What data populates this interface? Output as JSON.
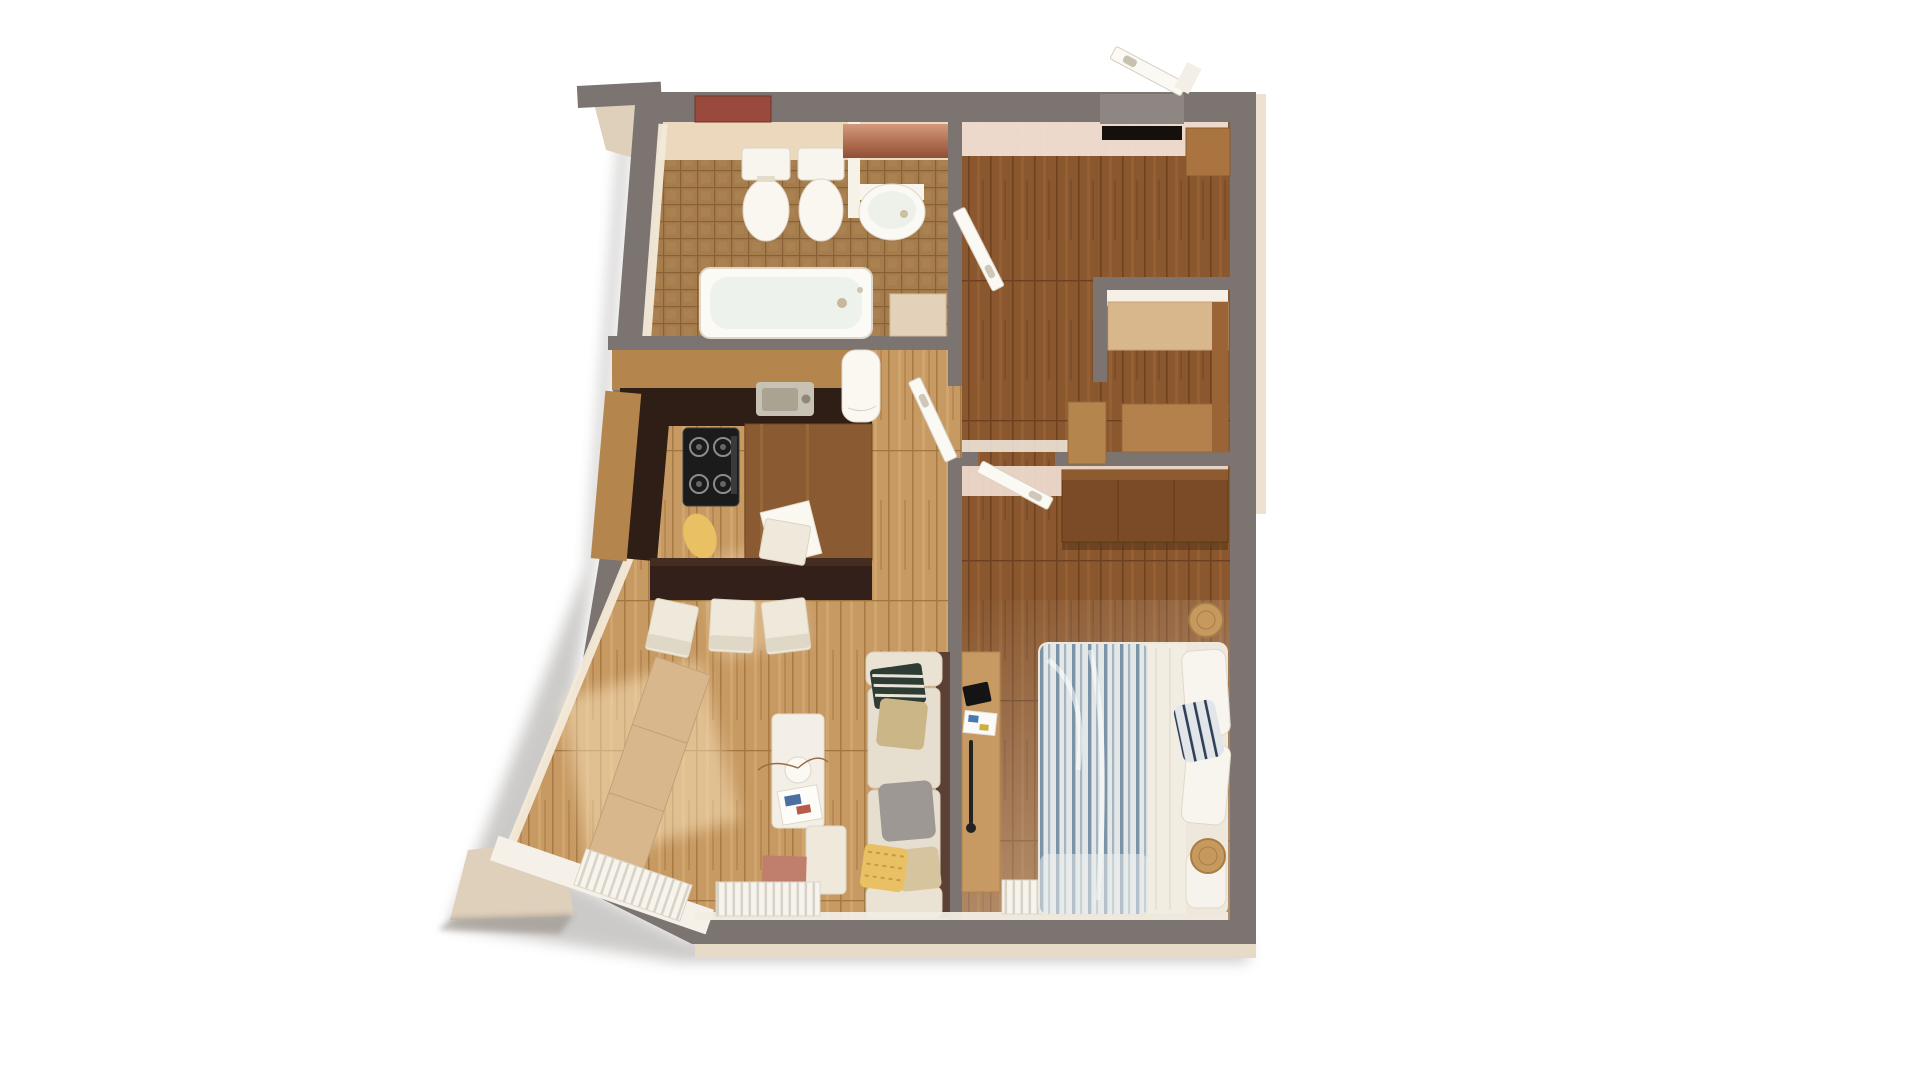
{
  "scene": {
    "type": "3d-floor-plan-render",
    "view": "top-down-axonometric",
    "canvas": {
      "width": 1920,
      "height": 1080
    },
    "background": "#ffffff",
    "visible_text": []
  },
  "palette": {
    "background": "#ffffff",
    "wall": "#7b7471",
    "wallEdge": "#8d8682",
    "plasterPink": "#f2e0d4",
    "tileFloor": "#a57c4c",
    "tileWall": "#ecd9bd",
    "woodFloorLight": "#c79a63",
    "woodFloorDark": "#8a572e",
    "woodLight": "#d9b78c",
    "woodMid": "#b5854e",
    "woodDark": "#7b4a26",
    "espresso": "#33201a",
    "counterDark": "#2e1e16",
    "white": "#f6f1e8",
    "cream": "#efe9dc",
    "copper": "#bf8066",
    "ventRed": "#9a4a3c",
    "terracotta": "#c07f6d",
    "yellow": "#e9c063",
    "khaki": "#cbb687",
    "olive": "#4a5a4a",
    "grayPillow": "#9e9894",
    "steel": "#c8c2b4",
    "black": "#1b1b1b",
    "balcony": "#ded0bb",
    "sofa": "#e6dfd0",
    "sofaBack": "#5d4034"
  },
  "rooms": {
    "bathroom": {
      "label": "bathroom",
      "floor": "brown mosaic tile",
      "fixtures": [
        "bathtub",
        "toilet",
        "bidet-toilet",
        "partition",
        "wall-hung-sink",
        "storage-cabinet",
        "copper-cabinet-row"
      ]
    },
    "hallway": {
      "label": "entrance hallway",
      "floor": "dark walnut planks",
      "fixtures": [
        "entrance-door-open-outward",
        "black-doormat",
        "shoe-cabinet",
        "bathroom-door-open",
        "living-room-door-open",
        "corridor-cabinet"
      ]
    },
    "closet": {
      "label": "walk-in closet",
      "floor": "dark walnut planks",
      "fixtures": [
        "upper-wood-counter",
        "lower-wood-counter",
        "side-wood-panel"
      ]
    },
    "kitchen_living": {
      "label": "kitchen and living room",
      "floor": "light oak planks with sunlight patches",
      "fixtures": [
        "kitchen-upper-cabinet-run",
        "steel-sink",
        "white-rounded-appliance",
        "dark-worktop",
        "gas-hob-4-burners",
        "walnut-kitchen-table",
        "cutting-board",
        "yellow-oval-stool",
        "white-side-chair",
        "espresso-dining-bar",
        "white-dining-chair-1",
        "white-dining-chair-2",
        "white-dining-chair-3",
        "wood-sideboard-along-slanted-wall",
        "white-coffee-table",
        "plant-pot",
        "magazine-tray",
        "beige-sectional-sofa",
        "striped-green-pillow",
        "khaki-pillow",
        "gray-pillow",
        "yellow-patterned-pillow",
        "beige-pillow",
        "white-ottoman",
        "terracotta-floor-mat",
        "radiator-slanted-window",
        "radiator-bottom-window"
      ]
    },
    "bedroom": {
      "label": "bedroom",
      "floor": "dark walnut planks",
      "fixtures": [
        "walnut-wardrobe",
        "wood-desk",
        "black-tablet",
        "magazines",
        "black-floor-lamp",
        "double-bed",
        "blue-striped-duvet",
        "white-sheet-fold",
        "white-pillows",
        "navy-striped-pillow",
        "blanket-roll",
        "round-wood-stool-top",
        "round-wood-stool-bottom",
        "bedroom-door-open",
        "radiator-left",
        "radiator-right"
      ]
    },
    "exterior": {
      "label": "exterior",
      "fixtures": [
        "slanted-left-wall",
        "top-left-balcony-ledge",
        "bottom-left-balcony-slab",
        "building-shadow"
      ]
    }
  }
}
